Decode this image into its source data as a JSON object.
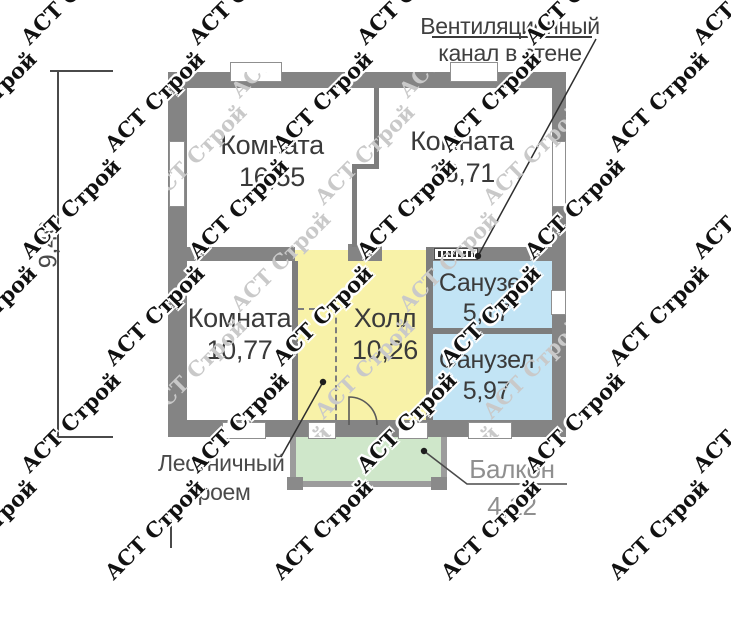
{
  "watermark": {
    "text": "АСТ Строй"
  },
  "plan": {
    "rooms": [
      {
        "id": "room-1",
        "name": "Комната",
        "area": "16,55"
      },
      {
        "id": "room-2",
        "name": "Комната",
        "area": "16,71"
      },
      {
        "id": "room-3",
        "name": "Комната",
        "area": "10,77"
      },
      {
        "id": "hall",
        "name": "Холл",
        "area": "10,26"
      },
      {
        "id": "bathroom-1",
        "name": "Санузел",
        "area": "5,17"
      },
      {
        "id": "bathroom-2",
        "name": "Санузел",
        "area": "5,97"
      },
      {
        "id": "balcony",
        "name": "Балкон",
        "area": "4,12"
      }
    ],
    "annotations": {
      "ventilation": {
        "line1": "Вентиляционный",
        "line2": "канал в стене"
      },
      "staircase": {
        "line1": "Лестничный",
        "line2": "проем"
      }
    },
    "dimensions": {
      "height_total": "9,40"
    },
    "colors": {
      "wall": "#848484",
      "hall_fill": "#f8f2a8",
      "bathroom_fill": "#c2e4f5",
      "balcony_fill": "#cfe7ca",
      "label_text": "#3a3a3a",
      "muted_text": "#8f8f8f"
    }
  }
}
